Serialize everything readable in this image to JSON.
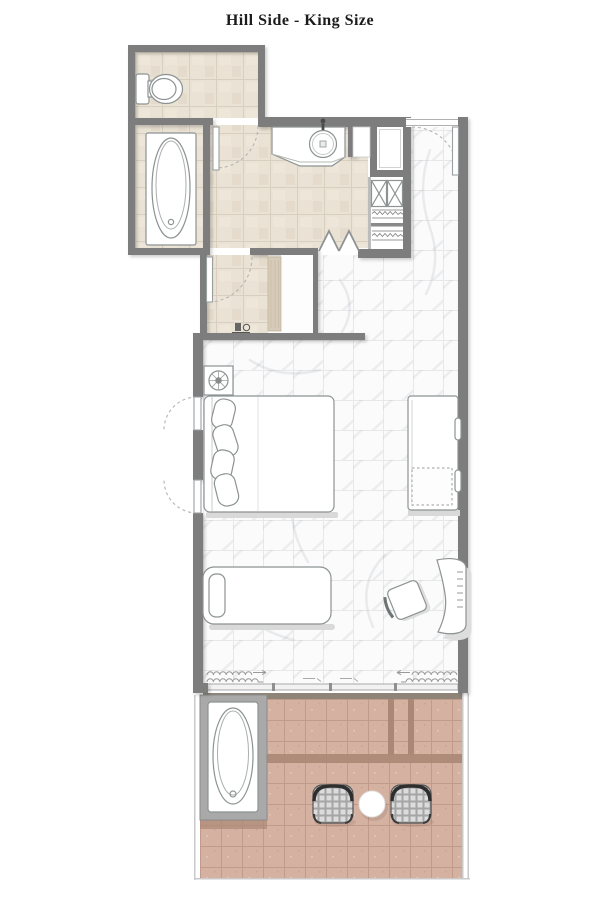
{
  "title": "Hill Side - King Size",
  "colors": {
    "text": "#1c1c1c",
    "wall": "#7d7d7d",
    "bathroomFloor": "#e9e2d5",
    "bathroomGrid": "#d9cfbf",
    "marbleFloor": "#fbfbfb",
    "marbleGrid": "#e8e8e8",
    "terraceFloor": "#d5b1a1",
    "terraceGrid": "#c19a89",
    "terraceDivider": "#ab8775",
    "terraceStep": "#8f8478",
    "platform": "#a9a9a9",
    "counterWood": "#d6cbb8",
    "fixtureLine": "#8d9292",
    "doorArc": "#b3b3b3",
    "shadow": "#d9d9d9"
  },
  "fixtures": {
    "toilet": "toilet",
    "indoor_bathtub": "bathtub",
    "vanity_sink": "round basin with faucet",
    "shower": "shower cabin",
    "wardrobe": "closet with shelves and rails",
    "bifold_doors": "folding closet doors",
    "king_bed": "king bed with pillows",
    "nightstand_lamp": "nightstand with lamp",
    "sofa": "sofa with throw",
    "chaise": "chaise lounge with pillow",
    "desk": "curved desk",
    "desk_chair": "desk chair",
    "curtains": "curtain waves",
    "outdoor_bathtub": "terrace bathtub on deck",
    "wicker_chairs": "two wicker chairs",
    "terrace_table": "round table",
    "coffee_station": "coffee tray"
  }
}
